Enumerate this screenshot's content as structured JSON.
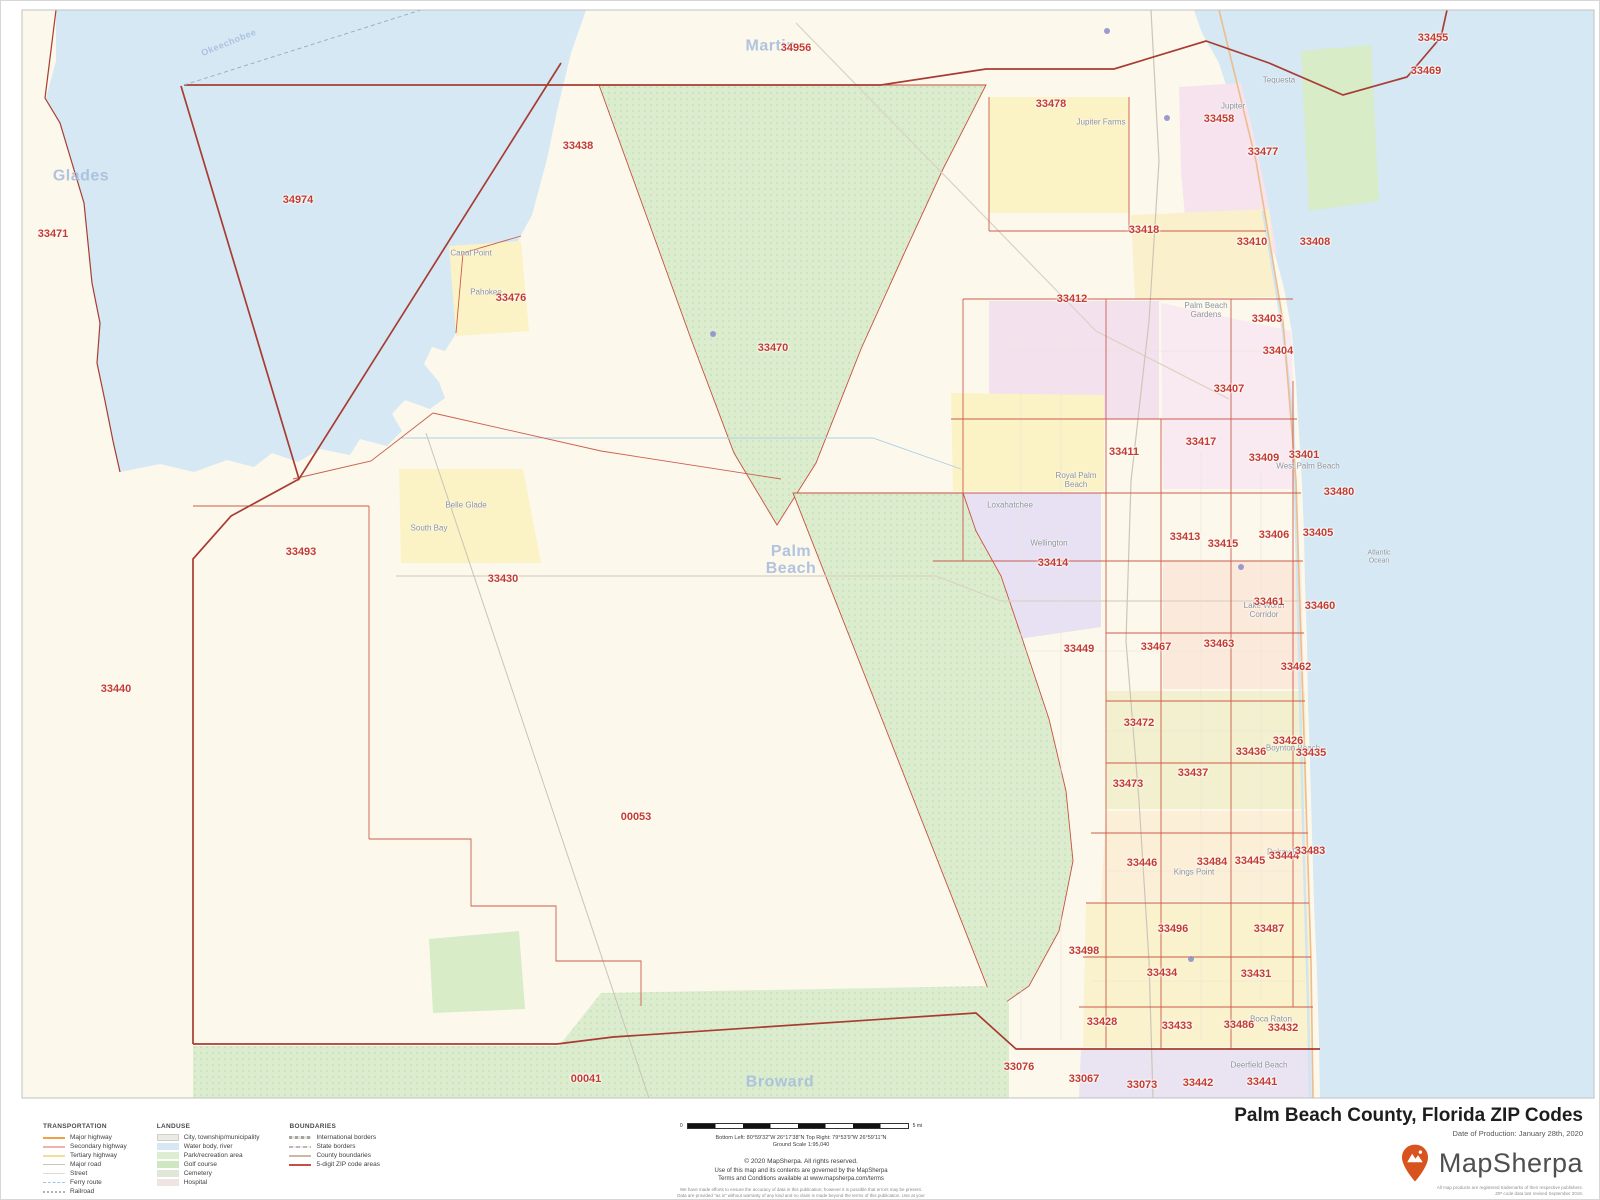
{
  "map": {
    "colors": {
      "land": "#fcf8ec",
      "water": "#d5e8f3",
      "park_green": "#dcedcf",
      "zip_boundary": "#c8503f",
      "county_boundary": "#a83c32",
      "zip_label": "#c43b2f",
      "county_label": "#a9bedd",
      "brand_orange": "#d9531e"
    },
    "zip_labels": [
      {
        "code": "34956",
        "x": 795,
        "y": 47
      },
      {
        "code": "33455",
        "x": 1432,
        "y": 37
      },
      {
        "code": "33469",
        "x": 1425,
        "y": 70
      },
      {
        "code": "33478",
        "x": 1050,
        "y": 103
      },
      {
        "code": "33458",
        "x": 1218,
        "y": 118
      },
      {
        "code": "33438",
        "x": 577,
        "y": 145
      },
      {
        "code": "33477",
        "x": 1262,
        "y": 151
      },
      {
        "code": "34974",
        "x": 297,
        "y": 199
      },
      {
        "code": "33471",
        "x": 52,
        "y": 233
      },
      {
        "code": "33418",
        "x": 1143,
        "y": 229
      },
      {
        "code": "33410",
        "x": 1251,
        "y": 241
      },
      {
        "code": "33408",
        "x": 1314,
        "y": 241
      },
      {
        "code": "33476",
        "x": 510,
        "y": 297
      },
      {
        "code": "33412",
        "x": 1071,
        "y": 298
      },
      {
        "code": "33403",
        "x": 1266,
        "y": 318
      },
      {
        "code": "33470",
        "x": 772,
        "y": 347
      },
      {
        "code": "33404",
        "x": 1277,
        "y": 350
      },
      {
        "code": "33407",
        "x": 1228,
        "y": 388
      },
      {
        "code": "33411",
        "x": 1123,
        "y": 451
      },
      {
        "code": "33417",
        "x": 1200,
        "y": 441
      },
      {
        "code": "33409",
        "x": 1263,
        "y": 457
      },
      {
        "code": "33401",
        "x": 1303,
        "y": 454
      },
      {
        "code": "33480",
        "x": 1338,
        "y": 491
      },
      {
        "code": "33413",
        "x": 1184,
        "y": 536
      },
      {
        "code": "33415",
        "x": 1222,
        "y": 543
      },
      {
        "code": "33406",
        "x": 1273,
        "y": 534
      },
      {
        "code": "33405",
        "x": 1317,
        "y": 532
      },
      {
        "code": "33414",
        "x": 1052,
        "y": 562
      },
      {
        "code": "33461",
        "x": 1268,
        "y": 601
      },
      {
        "code": "33460",
        "x": 1319,
        "y": 605
      },
      {
        "code": "33449",
        "x": 1078,
        "y": 648
      },
      {
        "code": "33467",
        "x": 1155,
        "y": 646
      },
      {
        "code": "33463",
        "x": 1218,
        "y": 643
      },
      {
        "code": "33462",
        "x": 1295,
        "y": 666
      },
      {
        "code": "33472",
        "x": 1138,
        "y": 722
      },
      {
        "code": "33436",
        "x": 1250,
        "y": 751
      },
      {
        "code": "33426",
        "x": 1287,
        "y": 740
      },
      {
        "code": "33435",
        "x": 1310,
        "y": 752
      },
      {
        "code": "33437",
        "x": 1192,
        "y": 772
      },
      {
        "code": "33473",
        "x": 1127,
        "y": 783
      },
      {
        "code": "33446",
        "x": 1141,
        "y": 862
      },
      {
        "code": "33484",
        "x": 1211,
        "y": 861
      },
      {
        "code": "33445",
        "x": 1249,
        "y": 860
      },
      {
        "code": "33444",
        "x": 1283,
        "y": 855
      },
      {
        "code": "33483",
        "x": 1309,
        "y": 850
      },
      {
        "code": "33496",
        "x": 1172,
        "y": 928
      },
      {
        "code": "33487",
        "x": 1268,
        "y": 928
      },
      {
        "code": "33498",
        "x": 1083,
        "y": 950
      },
      {
        "code": "33434",
        "x": 1161,
        "y": 972
      },
      {
        "code": "33431",
        "x": 1255,
        "y": 973
      },
      {
        "code": "33428",
        "x": 1101,
        "y": 1021
      },
      {
        "code": "33433",
        "x": 1176,
        "y": 1025
      },
      {
        "code": "33486",
        "x": 1238,
        "y": 1024
      },
      {
        "code": "33432",
        "x": 1282,
        "y": 1027
      },
      {
        "code": "33076",
        "x": 1018,
        "y": 1066
      },
      {
        "code": "33067",
        "x": 1083,
        "y": 1078
      },
      {
        "code": "33073",
        "x": 1141,
        "y": 1084
      },
      {
        "code": "33442",
        "x": 1197,
        "y": 1082
      },
      {
        "code": "33441",
        "x": 1261,
        "y": 1081
      },
      {
        "code": "33440",
        "x": 115,
        "y": 688
      },
      {
        "code": "33493",
        "x": 300,
        "y": 551
      },
      {
        "code": "33430",
        "x": 502,
        "y": 578
      },
      {
        "code": "00053",
        "x": 635,
        "y": 816
      },
      {
        "code": "00041",
        "x": 585,
        "y": 1078
      }
    ],
    "county_labels": [
      {
        "name": "Glades",
        "x": 80,
        "y": 176
      },
      {
        "name": "Okeechobee",
        "x": 228,
        "y": 42,
        "size": 9,
        "rotate": -22
      },
      {
        "name": "Martin",
        "x": 770,
        "y": 46
      },
      {
        "name": "Palm\nBeach",
        "x": 790,
        "y": 560
      },
      {
        "name": "Broward",
        "x": 779,
        "y": 1082
      }
    ],
    "city_labels": [
      {
        "name": "Canal Point",
        "x": 470,
        "y": 253
      },
      {
        "name": "Pahokee",
        "x": 485,
        "y": 292
      },
      {
        "name": "Belle Glade",
        "x": 465,
        "y": 505
      },
      {
        "name": "South Bay",
        "x": 428,
        "y": 528
      },
      {
        "name": "Tequesta",
        "x": 1278,
        "y": 80
      },
      {
        "name": "Jupiter",
        "x": 1232,
        "y": 106
      },
      {
        "name": "Jupiter Farms",
        "x": 1100,
        "y": 122
      },
      {
        "name": "Palm Beach\nGardens",
        "x": 1205,
        "y": 310
      },
      {
        "name": "West Palm Beach",
        "x": 1307,
        "y": 466
      },
      {
        "name": "Royal Palm\nBeach",
        "x": 1075,
        "y": 480
      },
      {
        "name": "Loxahatchee",
        "x": 1009,
        "y": 505
      },
      {
        "name": "Wellington",
        "x": 1048,
        "y": 543
      },
      {
        "name": "Lake Worth\nCorridor",
        "x": 1263,
        "y": 610
      },
      {
        "name": "Boynton Beach",
        "x": 1292,
        "y": 748
      },
      {
        "name": "Delray Beach",
        "x": 1290,
        "y": 852
      },
      {
        "name": "Kings Point",
        "x": 1193,
        "y": 872
      },
      {
        "name": "Boca Raton",
        "x": 1270,
        "y": 1019
      },
      {
        "name": "Deerfield Beach",
        "x": 1258,
        "y": 1065
      },
      {
        "name": "Atlantic\nOcean",
        "x": 1378,
        "y": 556,
        "size": 7
      }
    ]
  },
  "legend": {
    "sections": [
      {
        "title": "TRANSPORTATION",
        "items": [
          {
            "label": "Major highway",
            "swatch": "major-highway"
          },
          {
            "label": "Secondary highway",
            "swatch": "secondary-highway"
          },
          {
            "label": "Tertiary highway",
            "swatch": "tertiary-highway"
          },
          {
            "label": "Major road",
            "swatch": "major-road"
          },
          {
            "label": "Street",
            "swatch": "street"
          },
          {
            "label": "Ferry route",
            "swatch": "ferry-route"
          },
          {
            "label": "Railroad",
            "swatch": "railroad"
          }
        ]
      },
      {
        "title": "LANDUSE",
        "items": [
          {
            "label": "City, township/municipality",
            "swatch": "city"
          },
          {
            "label": "Water body, river",
            "swatch": "water"
          },
          {
            "label": "Park/recreation area",
            "swatch": "park"
          },
          {
            "label": "Golf course",
            "swatch": "golf"
          },
          {
            "label": "Cemetery",
            "swatch": "cemetery"
          },
          {
            "label": "Hospital",
            "swatch": "hospital"
          }
        ]
      },
      {
        "title": "BOUNDARIES",
        "items": [
          {
            "label": "International borders",
            "swatch": "international"
          },
          {
            "label": "State borders",
            "swatch": "state"
          },
          {
            "label": "County boundaries",
            "swatch": "county"
          },
          {
            "label": "5-digit ZIP code areas",
            "swatch": "zip"
          }
        ]
      }
    ]
  },
  "scalebar": {
    "left_label": "0",
    "right_label": "5 mi"
  },
  "credits": {
    "extent": "Bottom Left: 80°59'32\"W 26°17'38\"N   Top Right: 79°53'9\"W 26°59'11\"N",
    "ground_scale": "Ground Scale 1:95,040",
    "copyright": "© 2020 MapSherpa. All rights reserved.",
    "terms_line1": "Use of this map and its contents are governed by the MapSherpa",
    "terms_line2": "Terms and Conditions available at www.mapsherpa.com/terms",
    "disclaimer": "We have made efforts to ensure the accuracy of data in this publication; however it is possible that errors may be present. Data are provided \"as is\" without warranty of any kind and no claim is made beyond the terms of this publication. Use at your own risk."
  },
  "titleblock": {
    "title": "Palm Beach County, Florida ZIP Codes",
    "date": "Date of Production: January 28th, 2020",
    "brand": "MapSherpa",
    "fine_line1": "All map products are registered trademarks of their respective publishers.",
    "fine_line2": "ZIP code data last revised September 2019.",
    "promo_line1": "Custom ZIP code maps available for your area in the USA.",
    "promo_line2": "Find a retailer at www.mapsherpa.com/custommarketplace/retailpartners"
  }
}
